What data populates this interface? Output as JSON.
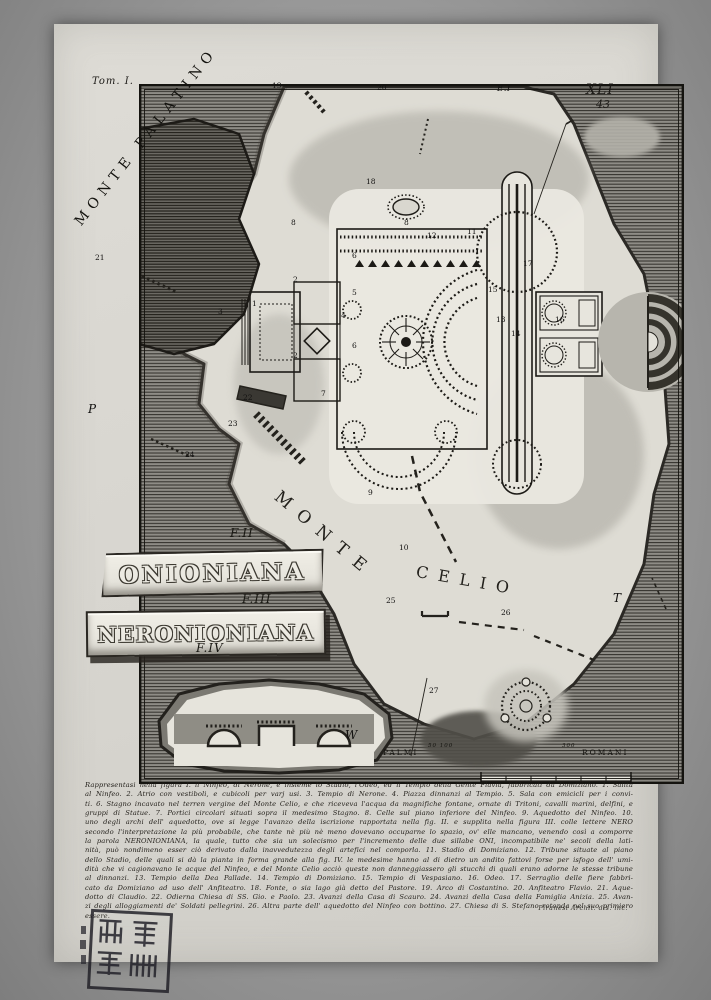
{
  "page": {
    "tome_label": "Tom. I.",
    "plate_number": "XLI",
    "page_number": "43"
  },
  "map": {
    "monte_palatino": "MONTE PALATINO",
    "monte_celio_word1": "MONTE",
    "monte_celio_word2": "CELIO",
    "markers": [
      {
        "t": "19",
        "x": 272,
        "y": 81
      },
      {
        "t": "20",
        "x": 377,
        "y": 83
      },
      {
        "t": "E.I",
        "x": 497,
        "y": 84,
        "cls": "md"
      },
      {
        "t": "21",
        "x": 95,
        "y": 253
      },
      {
        "t": "18",
        "x": 366,
        "y": 177
      },
      {
        "t": "8",
        "x": 291,
        "y": 218
      },
      {
        "t": "8",
        "x": 404,
        "y": 218
      },
      {
        "t": "1",
        "x": 252,
        "y": 299
      },
      {
        "t": "2",
        "x": 293,
        "y": 275
      },
      {
        "t": "2",
        "x": 293,
        "y": 351
      },
      {
        "t": "3",
        "x": 218,
        "y": 307
      },
      {
        "t": "4",
        "x": 341,
        "y": 311
      },
      {
        "t": "5",
        "x": 352,
        "y": 288
      },
      {
        "t": "6",
        "x": 352,
        "y": 251
      },
      {
        "t": "6",
        "x": 352,
        "y": 341
      },
      {
        "t": "7",
        "x": 321,
        "y": 389
      },
      {
        "t": "9",
        "x": 368,
        "y": 488
      },
      {
        "t": "10",
        "x": 399,
        "y": 543
      },
      {
        "t": "11",
        "x": 467,
        "y": 227
      },
      {
        "t": "12",
        "x": 427,
        "y": 231
      },
      {
        "t": "13",
        "x": 496,
        "y": 315
      },
      {
        "t": "14",
        "x": 511,
        "y": 329
      },
      {
        "t": "15",
        "x": 488,
        "y": 285
      },
      {
        "t": "16",
        "x": 555,
        "y": 315
      },
      {
        "t": "17",
        "x": 523,
        "y": 259
      },
      {
        "t": "22",
        "x": 243,
        "y": 393
      },
      {
        "t": "23",
        "x": 228,
        "y": 419
      },
      {
        "t": "24",
        "x": 185,
        "y": 450
      },
      {
        "t": "25",
        "x": 386,
        "y": 596
      },
      {
        "t": "26",
        "x": 501,
        "y": 608
      },
      {
        "t": "27",
        "x": 429,
        "y": 686
      },
      {
        "t": "P",
        "x": 88,
        "y": 402,
        "cls": "letter"
      },
      {
        "t": "T",
        "x": 613,
        "y": 591,
        "cls": "letter"
      },
      {
        "t": "W",
        "x": 345,
        "y": 728,
        "cls": "letter"
      }
    ]
  },
  "fragments": {
    "f2_label": "F.II",
    "f2_inscription": "ONIONIANA",
    "f3_label": "F.III",
    "f3_inscription": "NERONIONIANA",
    "f4_label": "F.IV"
  },
  "scale_bar": {
    "left_label": "PALMI",
    "right_label": "ROMANI",
    "start_numbers": "50 100",
    "end_number": "300"
  },
  "caption": {
    "lines": [
      "Rappresentasi nella figura I. il Ninfeo, di Nerone, e insieme lo Stadio, l'Odeo, ed il Tempio della Gente Flavia, fabbricati da Domiziano. 1. Salita",
      "al Ninfeo. 2. Atrio con vestiboli, e cubicoli per varj usi. 3. Tempio di Nerone. 4. Piazza dinnanzi al Tempio. 5. Sala con emicicli per i convi-",
      "ti. 6. Stagno incavato nel terren vergine del Monte Celio, e che riceveva l'acqua da magnifiche fontane, ornate di Tritoni, cavalli marini, delfini, e",
      "gruppi di Statue. 7. Portici circolari situati sopra il medesimo Stagno. 8. Celle sul piano inferiore del Ninfeo. 9. Aquedotto del Ninfeo. 10.",
      "uno degli archi dell' aquedotto, ove si legge l'avanzo della iscrizione rapportata nella fig. II. e supplita nella figura III. colle lettere NERO",
      "secondo l'interpretazione la più probabile, che tante nè più nè meno dovevano occuparne lo spazio, ov' elle mancano, venendo così a comporre",
      "la parola NERONIONIANA, la quale, tutto che sia un solecismo per l'incremento delle due sillabe ONI, incompatibile ne' secoli della lati-",
      "nità, può nondimeno esser ciò derivato dalla inavvedutezza degli artefici nel comporla. 11. Stadio di Domiziano. 12. Tribune situate al piano",
      "dello Stadio, delle quali si dà la pianta in forma grande alla fig. IV. le medesime hanno al di dietro un andito fattovi forse per isfogo dell' umi-",
      "dità che vi cagionavano le acque del Ninfeo, e del Monte Celio acciò queste non danneggiassero gli stucchi di quali erano adorne le stesse tribune",
      "al dinnanzi. 13. Tempio della Dea Pallade. 14. Tempio di Domiziano. 15. Tempio di Vespasiano. 16. Odeo. 17. Serraglio delle fiere fabbri-",
      "cato da Domiziano ad uso dell' Anfiteatro. 18. Fonte, o sia lago già detto del Pastore. 19. Arco di Costantino. 20. Anfiteatro Flavio. 21. Aque-",
      "dotto di Claudio. 22. Odierna Chiesa di SS. Gio. e Paolo. 23. Avanzi della Casa di Scauro. 24. Avanzi della Casa della Famiglia Anizia. 25. Avan-",
      "zi degli alloggiamenti de' Soldati pellegrini. 26. Altra parte dell' aquedotto del Ninfeo con bottino. 27. Chiesa di S. Stefano rotonda nel suo primiero essere."
    ],
    "signature": "Piranesi Archit. dis. inc."
  },
  "colors": {
    "paper": "#dad8d2",
    "ink": "#1c1a17",
    "hatch_bg": "#8e8c86",
    "terrain_light": "#dedcd4"
  }
}
